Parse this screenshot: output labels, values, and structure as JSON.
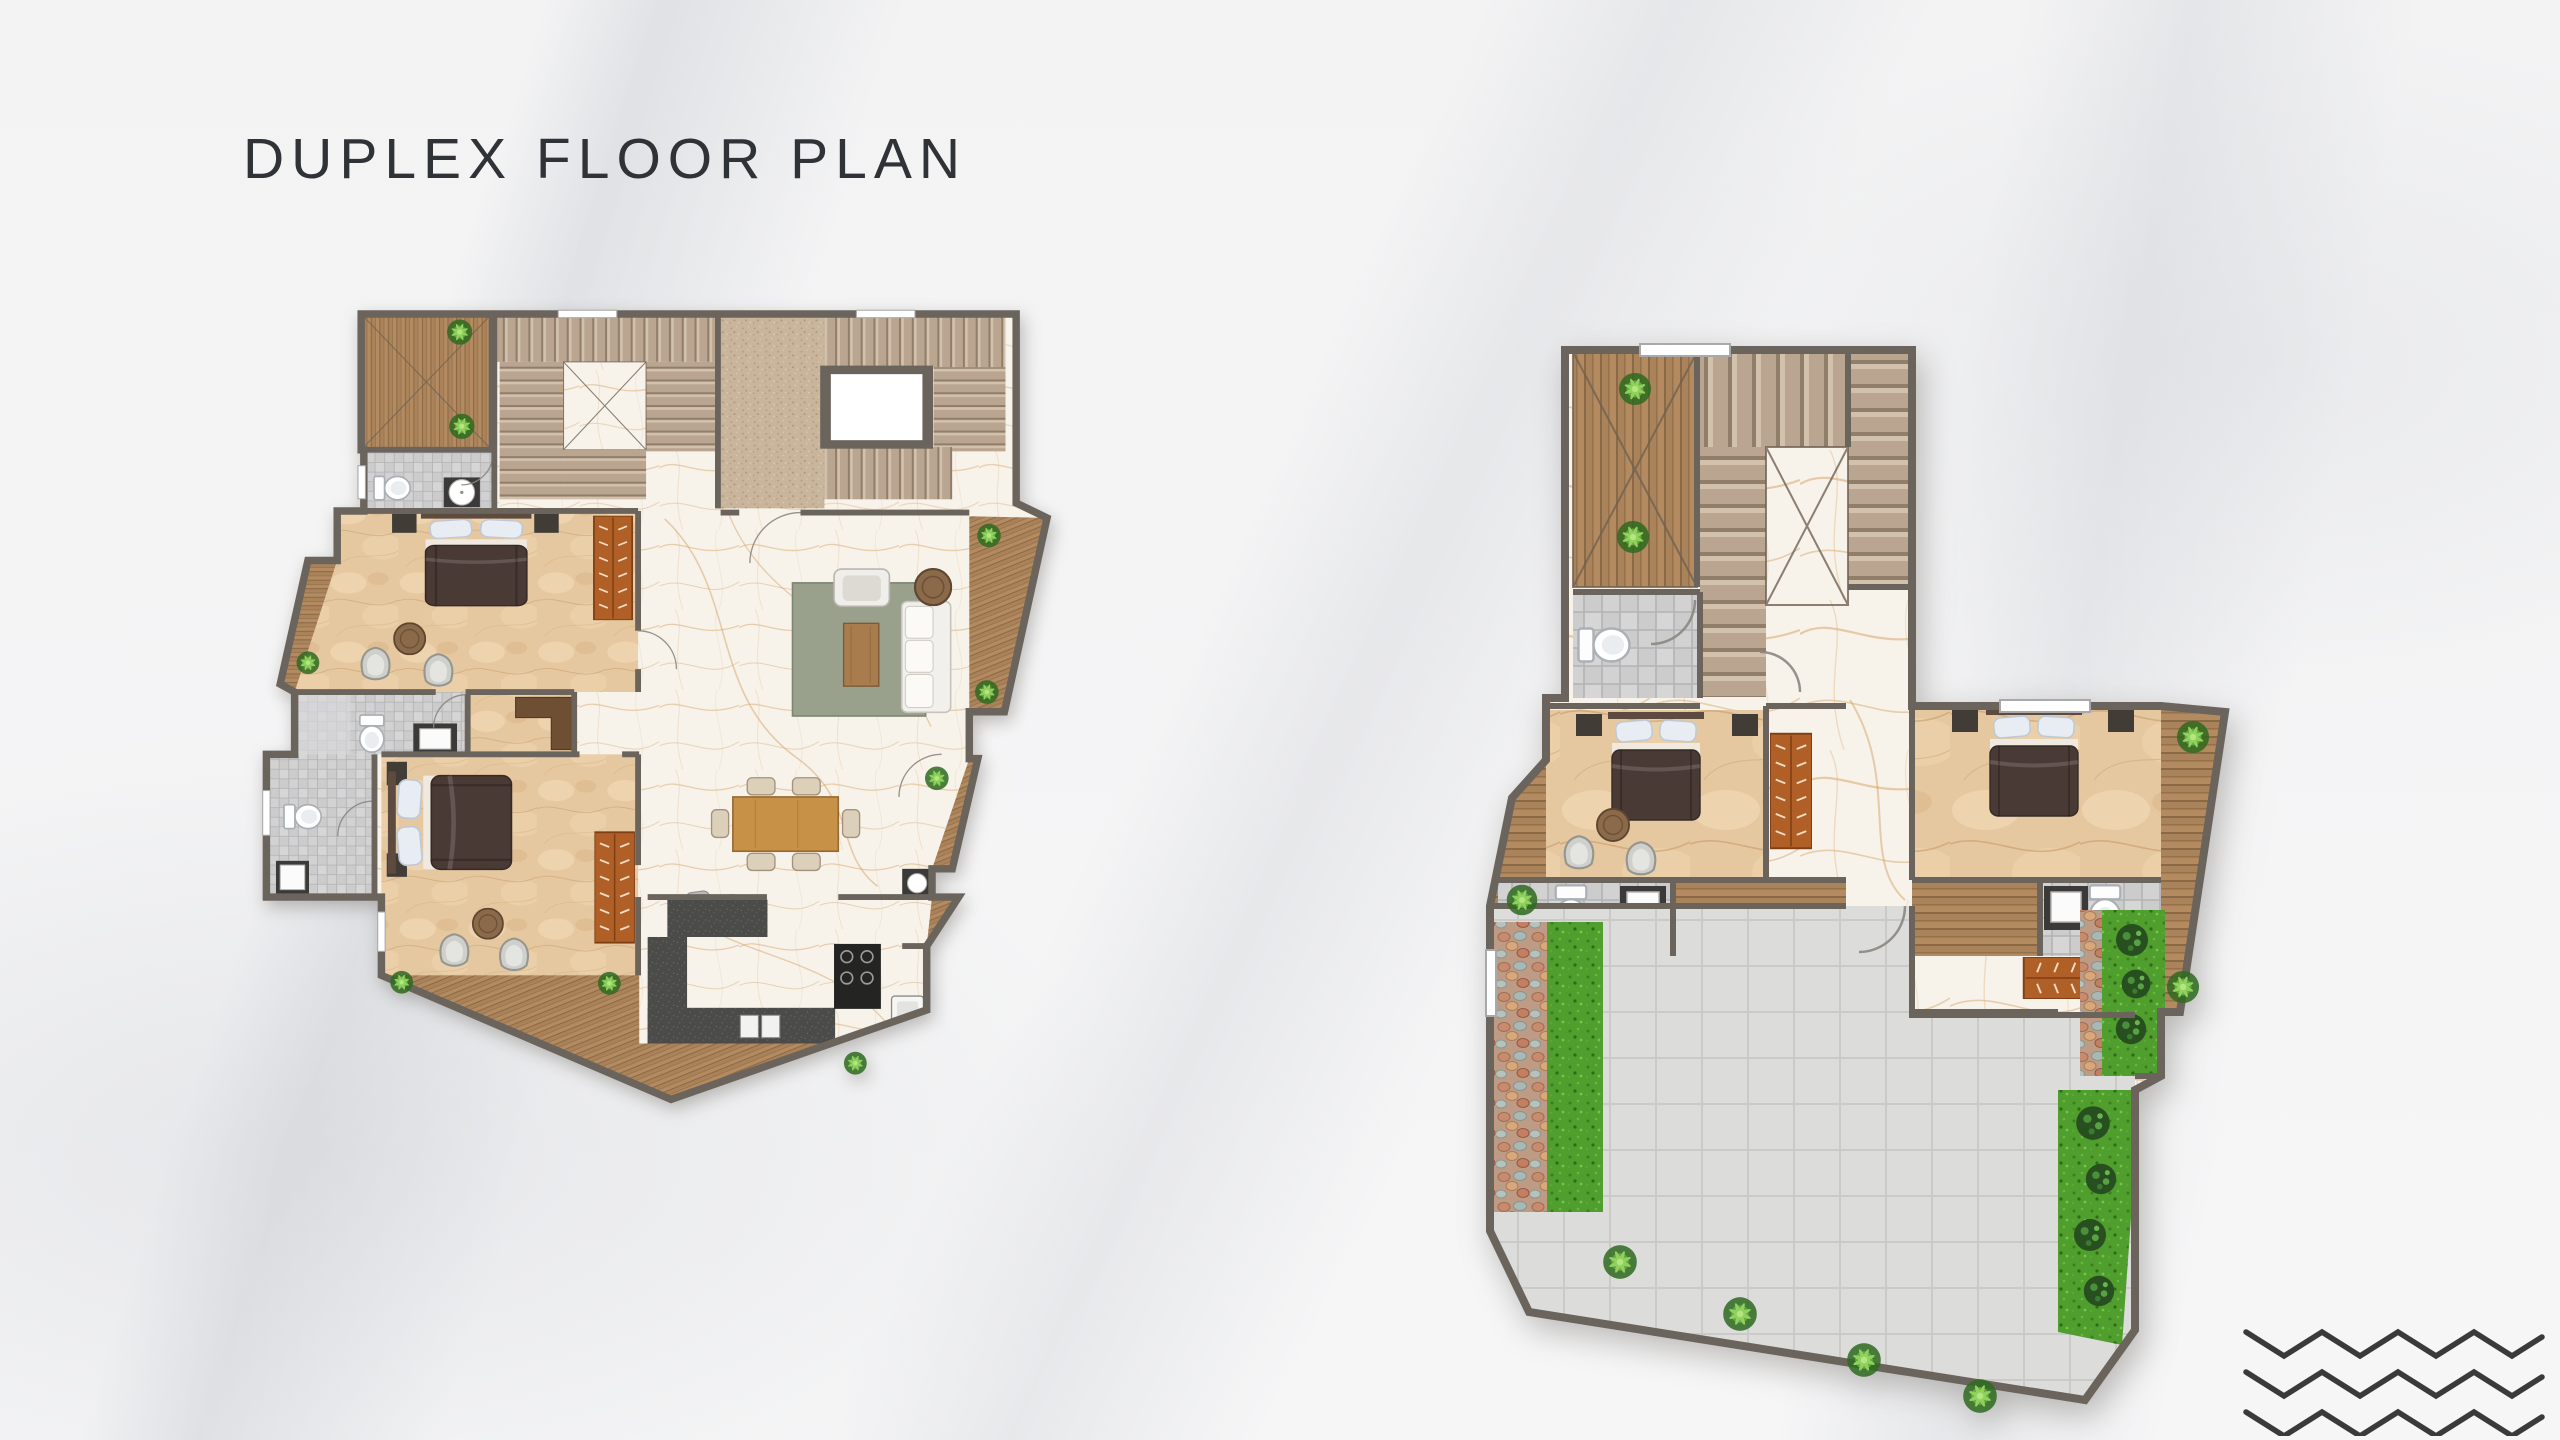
{
  "title": "DUPLEX FLOOR PLAN",
  "logo": {
    "rows": 3
  },
  "palette": {
    "text": "#2f3236",
    "logo": "#3a3a3a",
    "wall": "#6a645d",
    "beige": "#e6c8a0",
    "marble": "#f7f2ea",
    "wood": "#b48b61",
    "wood_dark": "#8f6c47",
    "stair": "#b9a590",
    "tile": "#cccccd",
    "paver": "#dcdcda",
    "grass": "#4f9e2e",
    "rug": "#99a08b",
    "counter": "#4b4b49",
    "bed": "#4a3a35",
    "wardrobe": "#b05f26",
    "sofa": "#f1f0ec",
    "table_wood": "#c89148"
  }
}
